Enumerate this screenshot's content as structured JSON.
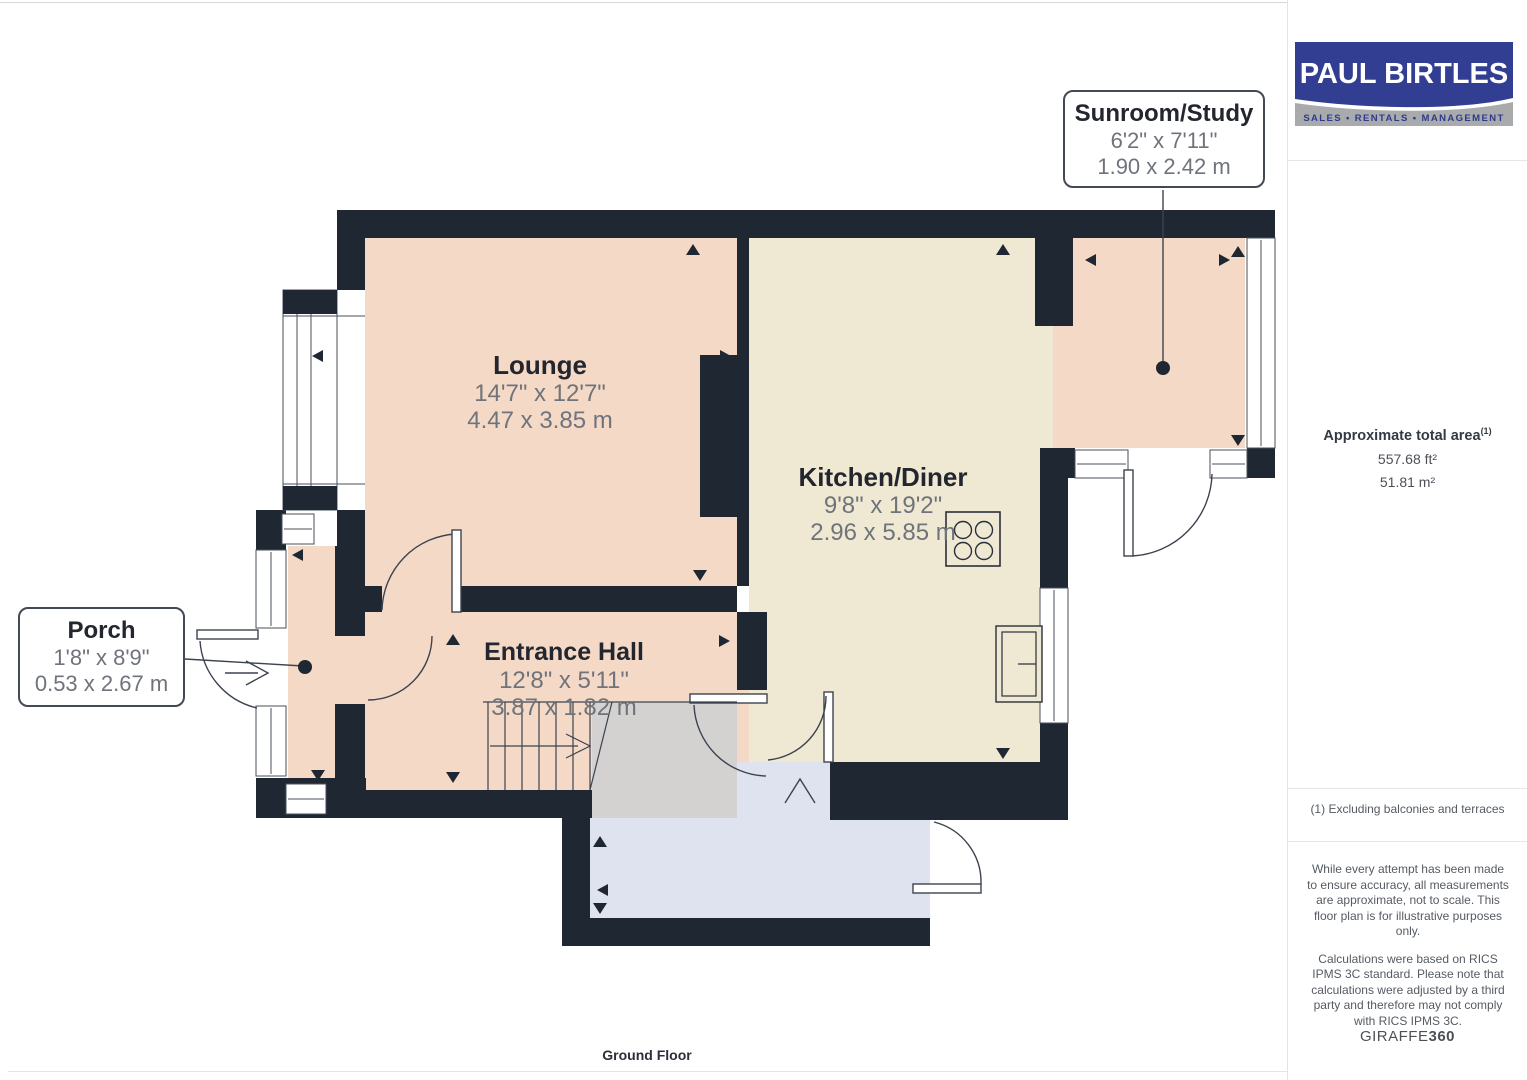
{
  "branding": {
    "logo_line1": "PAUL BIRTLES",
    "logo_line2": "SALES • RENTALS • MANAGEMENT",
    "logo_bg": "#323e92",
    "logo_band_bg": "#a8aaac"
  },
  "sidebar": {
    "area_title": "Approximate total area",
    "area_sup": "(1)",
    "area_ft": "557.68 ft²",
    "area_m": "51.81 m²",
    "footnote": "(1) Excluding balconies and terraces",
    "disclaimer1": "While every attempt has been made to ensure accuracy, all measurements are approximate, not to scale. This floor plan is for illustrative purposes only.",
    "disclaimer2": "Calculations were based on RICS IPMS 3C standard. Please note that calculations were adjusted by a third party and therefore may not comply with RICS IPMS 3C.",
    "watermark_regular": "GIRAFFE",
    "watermark_bold": "360"
  },
  "plan": {
    "floor_label": "Ground Floor",
    "rooms": [
      {
        "name": "Lounge",
        "imperial": "14'7\" x 12'7\"",
        "metric": "4.47 x 3.85 m"
      },
      {
        "name": "Kitchen/Diner",
        "imperial": "9'8\" x 19'2\"",
        "metric": "2.96 x 5.85 m"
      },
      {
        "name": "Entrance Hall",
        "imperial": "12'8\" x 5'11\"",
        "metric": "3.87 x 1.82 m"
      },
      {
        "name": "Porch",
        "imperial": "1'8\" x 8'9\"",
        "metric": "0.53 x 2.67 m"
      },
      {
        "name": "Sunroom/Study",
        "imperial": "6'2\" x 7'11\"",
        "metric": "1.90 x 2.42 m"
      }
    ],
    "colors": {
      "wall": "#1f2733",
      "room_pink": "#f4d9c6",
      "room_cream": "#efe8d3",
      "room_blue": "#dfe3f0",
      "stairs_gray": "#d3d2d1"
    }
  }
}
